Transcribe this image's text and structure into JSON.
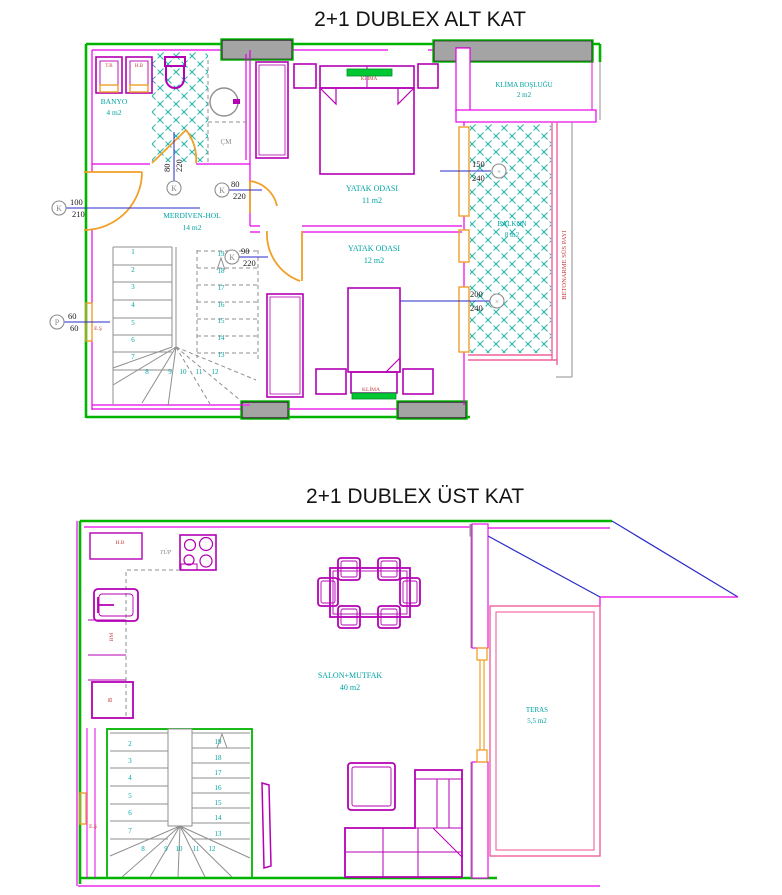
{
  "titles": {
    "alt": "2+1 DUBLEX ALT KAT",
    "ust": "2+1 DUBLEX ÜST KAT"
  },
  "alt": {
    "banyo_name": "BANYO",
    "banyo_area": "4 m2",
    "merdiven_name": "MERDİVEN-HOL",
    "merdiven_area": "14 m2",
    "yatak1_name": "YATAK ODASI",
    "yatak1_area": "11 m2",
    "yatak2_name": "YATAK ODASI",
    "yatak2_area": "12 m2",
    "klima_boslugu_name": "KLİMA BOŞLUĞU",
    "klima_boslugu_area": "2 m2",
    "balkon_name": "BALKON",
    "balkon_area": "8 m2",
    "tb": "T.B",
    "hb": "H.B",
    "cm": "ÇM",
    "es": "E.Ş",
    "klima_unit1": "KLİMA",
    "klima_unit2": "KLİMA",
    "betonarme": "BETONARME SÜS PAYI",
    "dims": {
      "d100": {
        "sym": "K",
        "a": "100",
        "b": "210"
      },
      "d80v": {
        "sym": "K",
        "a": "80",
        "b": "220"
      },
      "d80": {
        "sym": "K",
        "a": "80",
        "b": "220"
      },
      "d90": {
        "sym": "K",
        "a": "90",
        "b": "220"
      },
      "d150": {
        "sym": "×",
        "a": "150",
        "b": "240"
      },
      "d200": {
        "sym": "×",
        "a": "200",
        "b": "240"
      },
      "d60": {
        "sym": "P",
        "a": "60",
        "b": "60"
      }
    },
    "stairs": [
      "1",
      "2",
      "3",
      "4",
      "5",
      "6",
      "7",
      "8",
      "9",
      "10",
      "11",
      "12",
      "13",
      "14",
      "15",
      "16",
      "17",
      "18",
      "19"
    ]
  },
  "ust": {
    "salon_name": "SALON+MUTFAK",
    "salon_area": "40 m2",
    "teras_name": "TERAS",
    "teras_area": "5,5 m2",
    "hb": "H.B",
    "tup": "TÜP",
    "bm": "BM",
    "b": "B",
    "es": "E.Ş",
    "stairs": [
      "2",
      "3",
      "4",
      "5",
      "6",
      "7",
      "8",
      "9",
      "10",
      "11",
      "12",
      "13",
      "14",
      "15",
      "16",
      "17",
      "18",
      "19"
    ]
  }
}
